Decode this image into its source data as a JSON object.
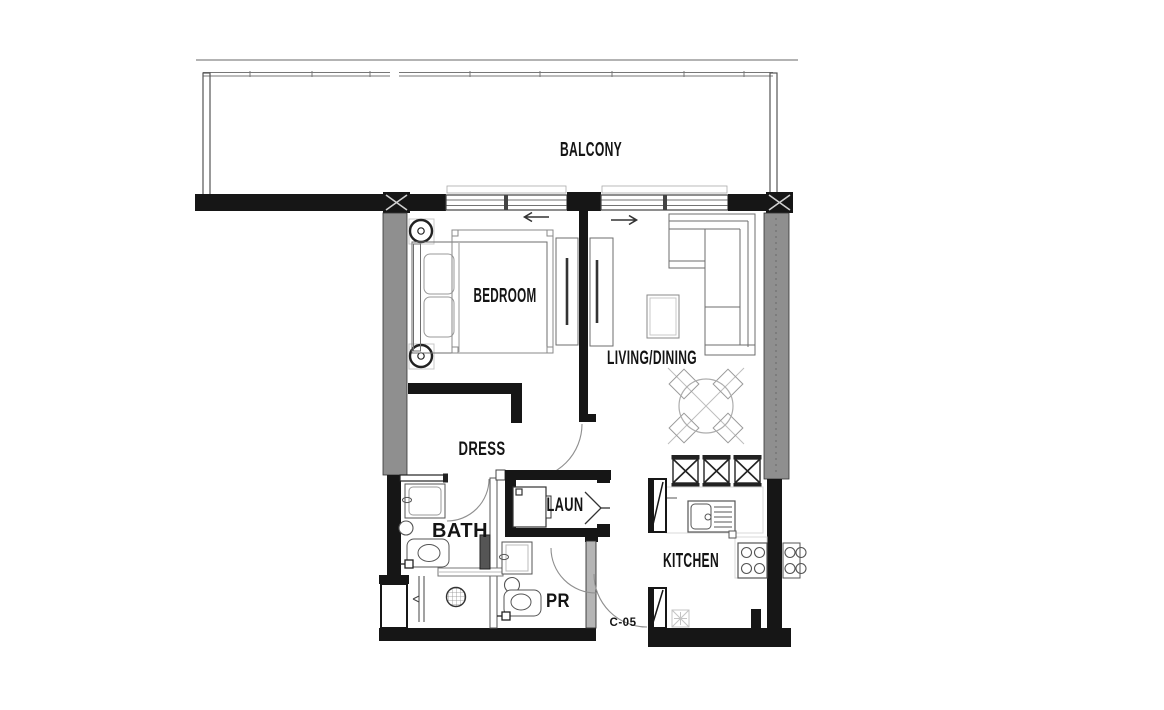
{
  "plan": {
    "unit_label": "C-05",
    "rooms": {
      "balcony": "BALCONY",
      "bedroom": "BEDROOM",
      "living_dining": "LIVING/DINING",
      "dress": "DRESS",
      "bath": "BATH",
      "laundry": "LAUN",
      "powder_room": "PR",
      "kitchen": "KITCHEN"
    },
    "colors": {
      "wall": "#161616",
      "pier_gray": "#8f8f8f",
      "furniture_line": "#6e6e6e",
      "light_line": "#c9c9c9",
      "background": "#ffffff"
    }
  }
}
